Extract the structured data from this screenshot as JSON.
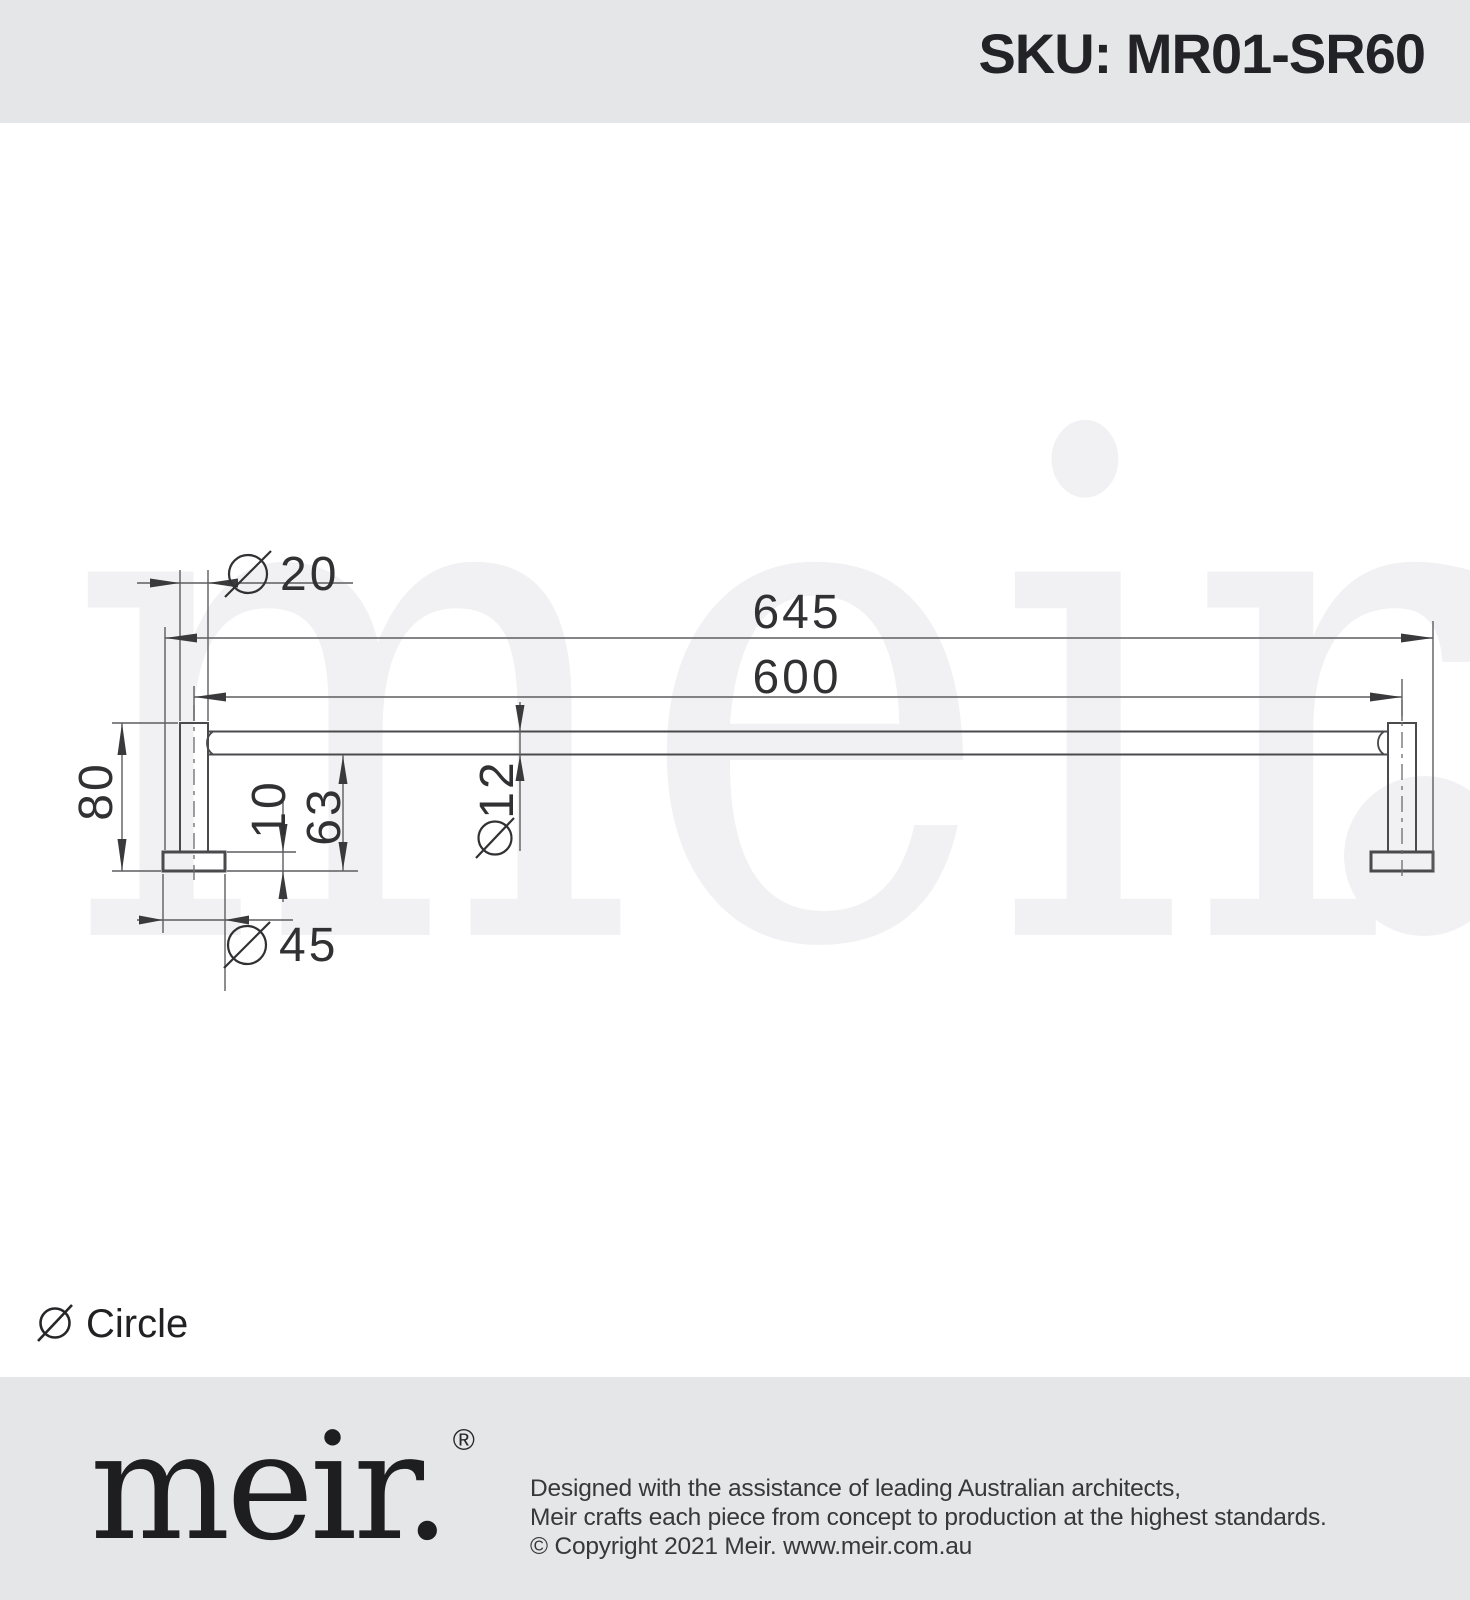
{
  "header": {
    "sku_label": "SKU: MR01-SR60"
  },
  "drawing": {
    "watermark": "meir",
    "watermark_period": ".",
    "product": "600mm single towel rail side elevation",
    "dimensions": [
      {
        "id": "post-diameter",
        "symbol": "∅",
        "value": "20"
      },
      {
        "id": "overall-length",
        "symbol": "",
        "value": "645"
      },
      {
        "id": "centres-length",
        "symbol": "",
        "value": "600"
      },
      {
        "id": "overall-height",
        "symbol": "",
        "value": "80"
      },
      {
        "id": "flange-thickness",
        "symbol": "∅",
        "value": "10"
      },
      {
        "id": "under-clearance",
        "symbol": "",
        "value": "63"
      },
      {
        "id": "rail-diameter",
        "symbol": "∅",
        "value": "12"
      },
      {
        "id": "flange-diameter",
        "symbol": "∅",
        "value": "45"
      }
    ]
  },
  "legend": {
    "symbol": "∅",
    "label": "Circle"
  },
  "footer": {
    "logo": "meir.",
    "logo_mark": "®",
    "lines": [
      "Designed with the assistance of leading Australian architects,",
      "Meir crafts each piece from concept to production at the highest standards.",
      "© Copyright 2021 Meir. www.meir.com.au"
    ]
  },
  "colors": {
    "band_gray": "#e4e6e8",
    "object_line": "#4a4a4d",
    "dimension_line": "#5d5d60",
    "dimension_text": "#313134",
    "watermark_gray": "#f1f1f3",
    "text_dark": "#232327"
  }
}
